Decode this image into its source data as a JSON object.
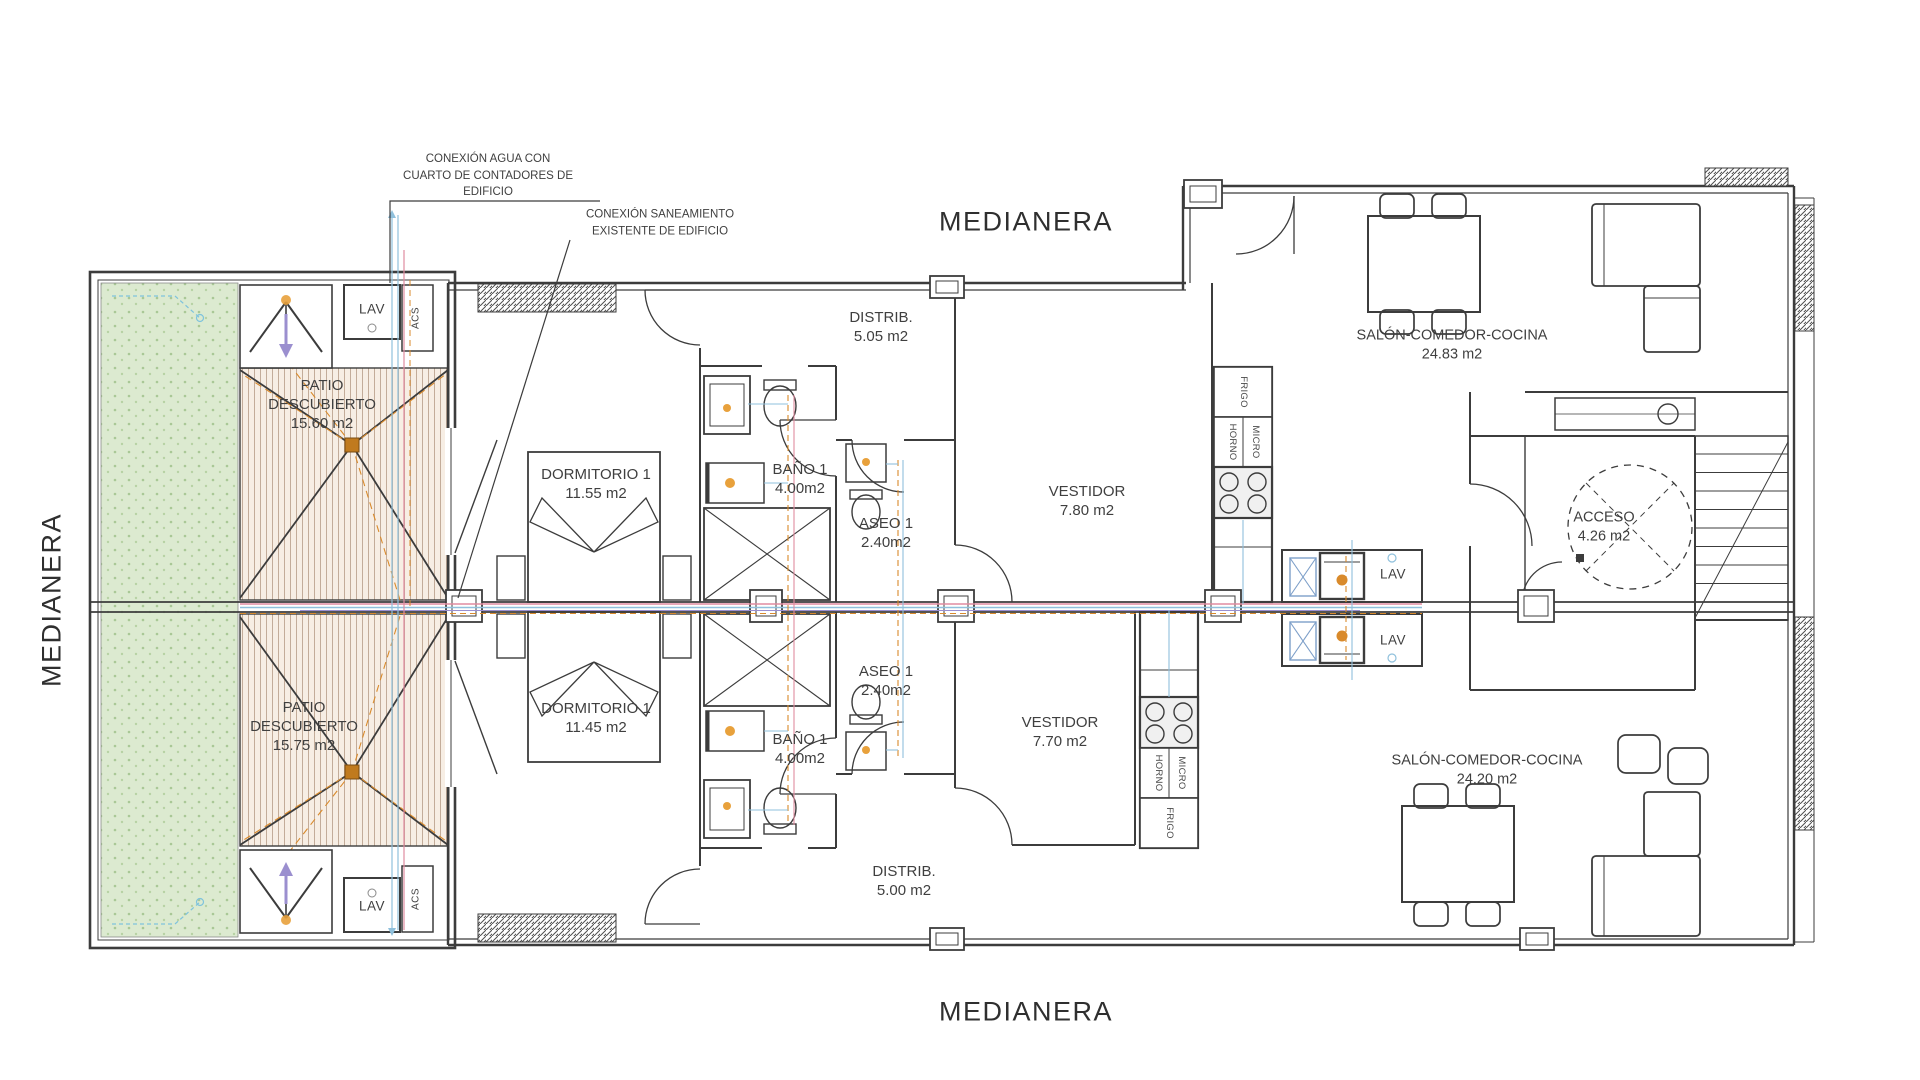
{
  "drawing": {
    "boundary_labels": {
      "top": "MEDIANERA",
      "left": "MEDIANERA",
      "bottom": "MEDIANERA"
    },
    "annotations": {
      "water_line1": "CONEXIÓN AGUA CON",
      "water_line2": "CUARTO DE CONTADORES DE",
      "water_line3": "EDIFICIO",
      "sewer_line1": "CONEXIÓN SANEAMIENTO",
      "sewer_line2": "EXISTENTE DE EDIFICIO"
    },
    "rooms": {
      "patio_top": {
        "line1": "PATIO",
        "line2": "DESCUBIERTO",
        "area": "15.60 m2"
      },
      "patio_bottom": {
        "line1": "PATIO",
        "line2": "DESCUBIERTO",
        "area": "15.75 m2"
      },
      "dormitorio_top": {
        "name": "DORMITORIO 1",
        "area": "11.55 m2"
      },
      "dormitorio_bottom": {
        "name": "DORMITORIO 1",
        "area": "11.45 m2"
      },
      "bano_top": {
        "name": "BAÑO 1",
        "area": "4.00m2"
      },
      "bano_bottom": {
        "name": "BAÑO 1",
        "area": "4.00m2"
      },
      "aseo_top": {
        "name": "ASEO 1",
        "area": "2.40m2"
      },
      "aseo_bottom": {
        "name": "ASEO 1",
        "area": "2.40m2"
      },
      "distrib_top": {
        "name": "DISTRIB.",
        "area": "5.05 m2"
      },
      "distrib_bottom": {
        "name": "DISTRIB.",
        "area": "5.00 m2"
      },
      "vestidor_top": {
        "name": "VESTIDOR",
        "area": "7.80 m2"
      },
      "vestidor_bottom": {
        "name": "VESTIDOR",
        "area": "7.70 m2"
      },
      "salon_top": {
        "name": "SALÓN-COMEDOR-COCINA",
        "area": "24.83 m2"
      },
      "salon_bottom": {
        "name": "SALÓN-COMEDOR-COCINA",
        "area": "24.20 m2"
      },
      "acceso": {
        "name": "ACCESO",
        "area": "4.26 m2"
      }
    },
    "equipment": {
      "lav_patio_top": "LAV",
      "acs_top": "ACS",
      "lav_patio_bottom": "LAV",
      "acs_bottom": "ACS",
      "lav_right_top": "LAV",
      "lav_right_bottom": "LAV",
      "frigo_top": "FRIGO",
      "horno_top": "HORNO",
      "micro_top": "MICRO",
      "frigo_bottom": "FRIGO",
      "horno_bottom": "HORNO",
      "micro_bottom": "MICRO"
    },
    "colors": {
      "line": "#3c3c3c",
      "text": "#3f3f3f",
      "garden_green": "#dcead0",
      "patio_cream": "#f7eee4",
      "pipe_blue": "#8fc0dc",
      "pipe_pink": "#e08ca0",
      "pipe_orange": "#d98a2b",
      "pipe_purple": "#9b8fcf",
      "drain_orange": "#c07a1e"
    }
  }
}
